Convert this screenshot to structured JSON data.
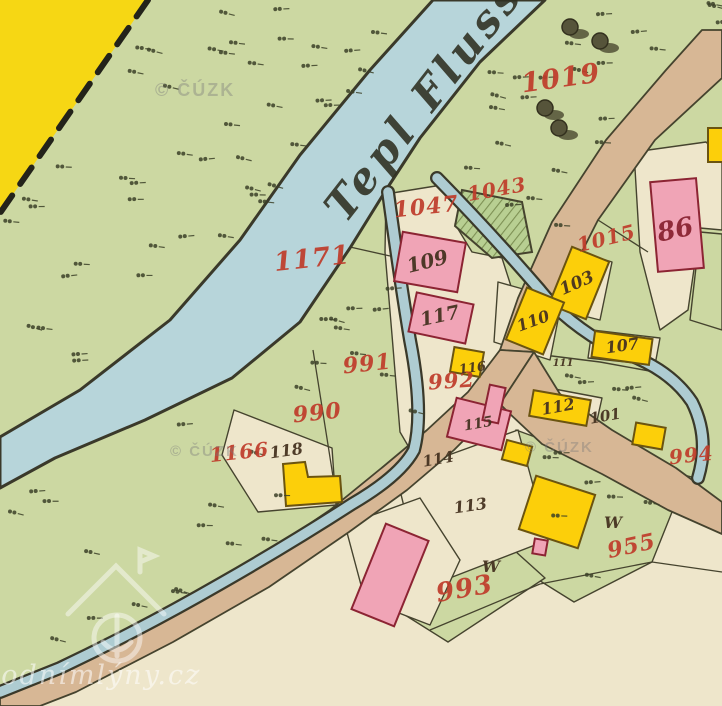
{
  "map": {
    "river_label": "Tepl Fluss",
    "watermark_cuzk": "© ČÚZK",
    "watermark_site": "vodnímlýny.cz",
    "colors": {
      "meadow": "#ccd8a2",
      "parcel_cream": "#eee6cb",
      "river": "#b7d5da",
      "stream": "#aeccd2",
      "water_edge": "#3a392a",
      "road": "#d7b795",
      "highway": "#f6d714",
      "outline": "#45432e",
      "masonry": "#f0a4b6",
      "masonry_edge": "#8c2433",
      "wood": "#fccf0a",
      "wood_edge": "#6b5410",
      "ink_red": "#bf3b2a",
      "ink_dark": "#463321",
      "ink_house_red": "#8a2433",
      "tree": "#56543a",
      "garden": "#b8cf92",
      "hatch": "#7d9054",
      "mark": "#3c4128"
    },
    "labels": {
      "red": [
        {
          "t": "1019",
          "x": 562,
          "y": 87,
          "s": 27,
          "r": -8
        },
        {
          "t": "1171",
          "x": 313,
          "y": 267,
          "s": 26,
          "r": -6
        },
        {
          "t": "1047",
          "x": 427,
          "y": 214,
          "s": 22,
          "r": -6
        },
        {
          "t": "1043",
          "x": 498,
          "y": 196,
          "s": 20,
          "r": -10
        },
        {
          "t": "1015",
          "x": 608,
          "y": 245,
          "s": 20,
          "r": -14
        },
        {
          "t": "991",
          "x": 368,
          "y": 371,
          "s": 22,
          "r": -6
        },
        {
          "t": "990",
          "x": 318,
          "y": 420,
          "s": 22,
          "r": -6
        },
        {
          "t": "992",
          "x": 452,
          "y": 388,
          "s": 21,
          "r": -4
        },
        {
          "t": "1166",
          "x": 240,
          "y": 459,
          "s": 20,
          "r": -6
        },
        {
          "t": "993",
          "x": 466,
          "y": 597,
          "s": 26,
          "r": -10
        },
        {
          "t": "994",
          "x": 692,
          "y": 462,
          "s": 20,
          "r": -6
        },
        {
          "t": "955",
          "x": 633,
          "y": 553,
          "s": 22,
          "r": -12
        }
      ],
      "dark": [
        {
          "t": "86",
          "x": 677,
          "y": 238,
          "s": 26,
          "r": -12,
          "c": "house_red"
        },
        {
          "t": "109",
          "x": 429,
          "y": 268,
          "s": 20,
          "r": -14
        },
        {
          "t": "117",
          "x": 441,
          "y": 322,
          "s": 19,
          "r": -12
        },
        {
          "t": "103",
          "x": 579,
          "y": 288,
          "s": 17,
          "r": -24
        },
        {
          "t": "110",
          "x": 535,
          "y": 326,
          "s": 16,
          "r": -20
        },
        {
          "t": "107",
          "x": 623,
          "y": 351,
          "s": 16,
          "r": -8
        },
        {
          "t": "116",
          "x": 473,
          "y": 372,
          "s": 13,
          "r": -8
        },
        {
          "t": "115",
          "x": 479,
          "y": 428,
          "s": 14,
          "r": -10
        },
        {
          "t": "112",
          "x": 559,
          "y": 412,
          "s": 16,
          "r": -10
        },
        {
          "t": "111",
          "x": 563,
          "y": 366,
          "s": 10,
          "r": 0
        },
        {
          "t": "101",
          "x": 606,
          "y": 421,
          "s": 15,
          "r": -10
        },
        {
          "t": "118",
          "x": 287,
          "y": 456,
          "s": 16,
          "r": -8
        },
        {
          "t": "114",
          "x": 439,
          "y": 464,
          "s": 15,
          "r": -10
        },
        {
          "t": "113",
          "x": 471,
          "y": 511,
          "s": 16,
          "r": -8
        },
        {
          "t": "W",
          "x": 491,
          "y": 572,
          "s": 16,
          "r": 0
        },
        {
          "t": "W",
          "x": 613,
          "y": 528,
          "s": 16,
          "r": 0
        }
      ]
    }
  }
}
